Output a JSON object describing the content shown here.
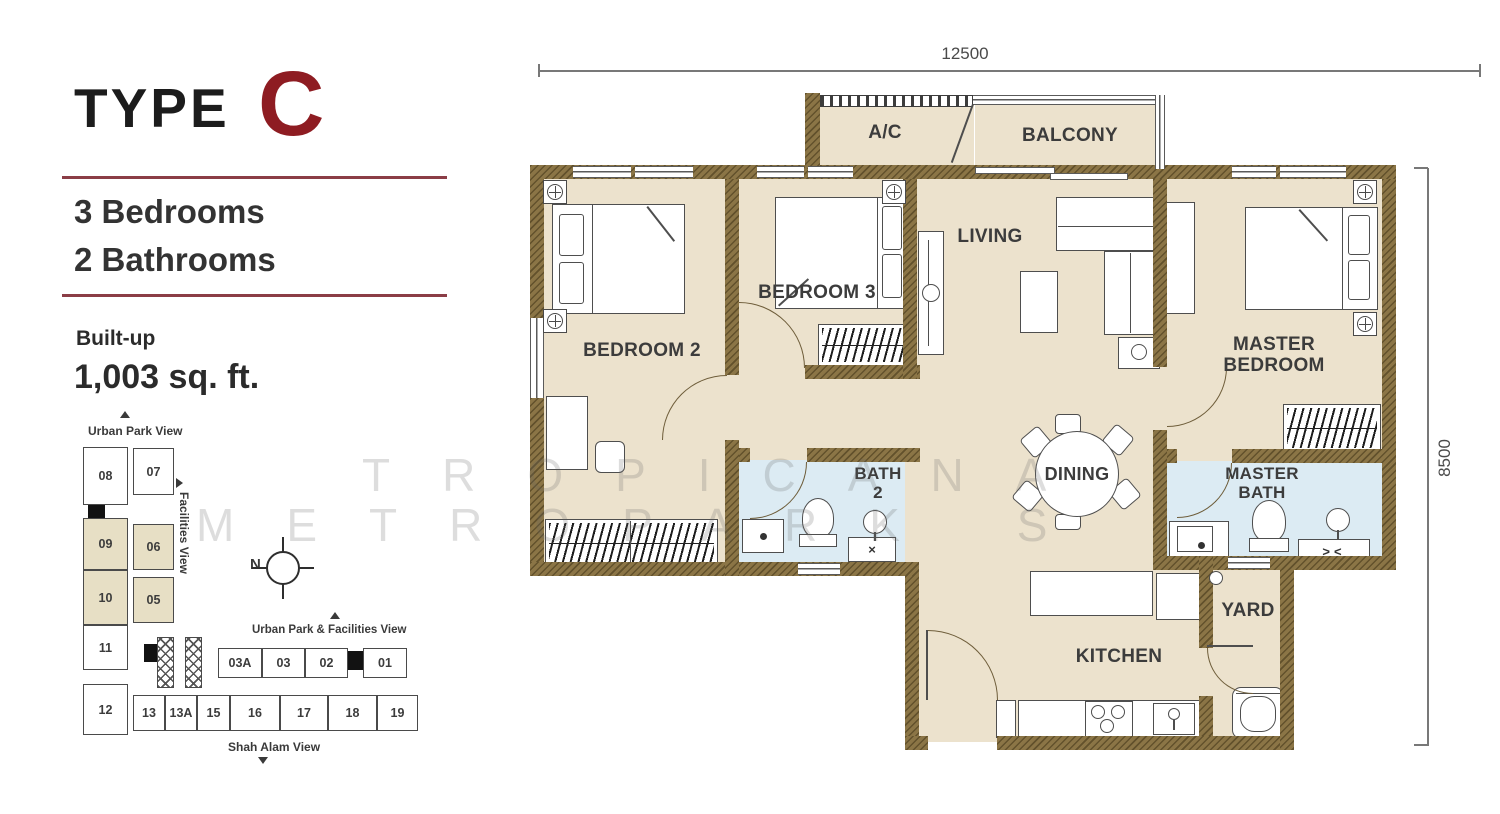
{
  "panel": {
    "type_label": "TYPE",
    "type_letter": "C",
    "bedrooms": "3 Bedrooms",
    "bathrooms": "2 Bathrooms",
    "builtup_label": "Built-up",
    "builtup_value": "1,003 sq. ft."
  },
  "dimensions": {
    "width": "12500",
    "height": "8500"
  },
  "watermark": {
    "line1": "TROPICANA",
    "line2": "METROPARK S"
  },
  "plan": {
    "rooms": {
      "ac": "A/C",
      "balcony": "BALCONY",
      "living": "LIVING",
      "bedroom2": "BEDROOM 2",
      "bedroom3": "BEDROOM 3",
      "master_bedroom": "MASTER BEDROOM",
      "bath2": "BATH 2",
      "dining": "DINING",
      "master_bath": "MASTER BATH",
      "yard": "YARD",
      "kitchen": "KITCHEN"
    },
    "symbols": {
      "vanity_cross": "×",
      "vanity_double": "><"
    }
  },
  "keyplan": {
    "views": {
      "top": "Urban Park View",
      "side": "Facilities View",
      "middle": "Urban Park & Facilities View",
      "bottom": "Shah Alam View"
    },
    "north": "N",
    "units": {
      "u08": "08",
      "u07": "07",
      "u09": "09",
      "u06": "06",
      "u10": "10",
      "u05": "05",
      "u11": "11",
      "u12": "12",
      "u13": "13",
      "u13a": "13A",
      "u15": "15",
      "u16": "16",
      "u17": "17",
      "u18": "18",
      "u19": "19",
      "u03a": "03A",
      "u03": "03",
      "u02": "02",
      "u01": "01"
    }
  },
  "colors": {
    "accent": "#8e1c22",
    "wall": "#8b7546",
    "floor": "#ece2cd",
    "bath_floor": "#dcebf3",
    "keyplan_highlight": "#e7dfc5"
  }
}
